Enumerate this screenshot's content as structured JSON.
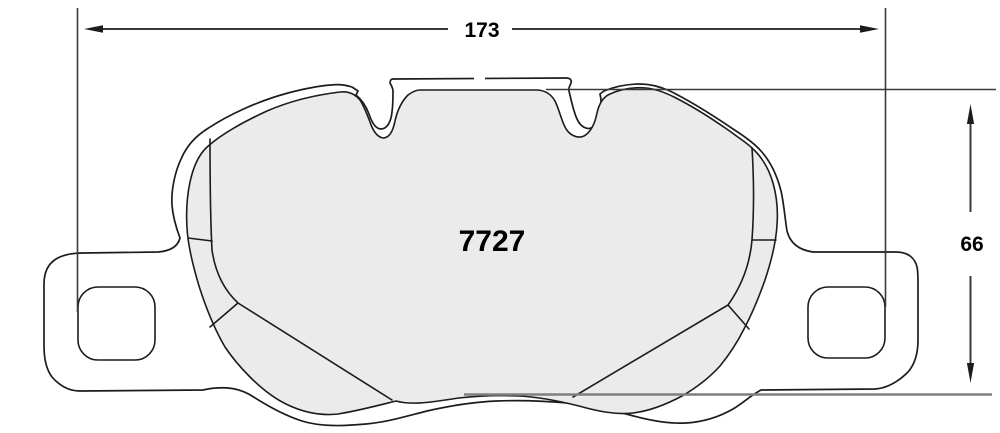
{
  "drawing": {
    "part_number": "7727",
    "dim_width": "173",
    "dim_height": "66"
  },
  "colors": {
    "outline": "#1c1c1c",
    "friction_fill": "#ebebeb",
    "dimension_line": "#3a3a3a",
    "extension_gray": "#7f7f7f",
    "background": "#ffffff"
  }
}
